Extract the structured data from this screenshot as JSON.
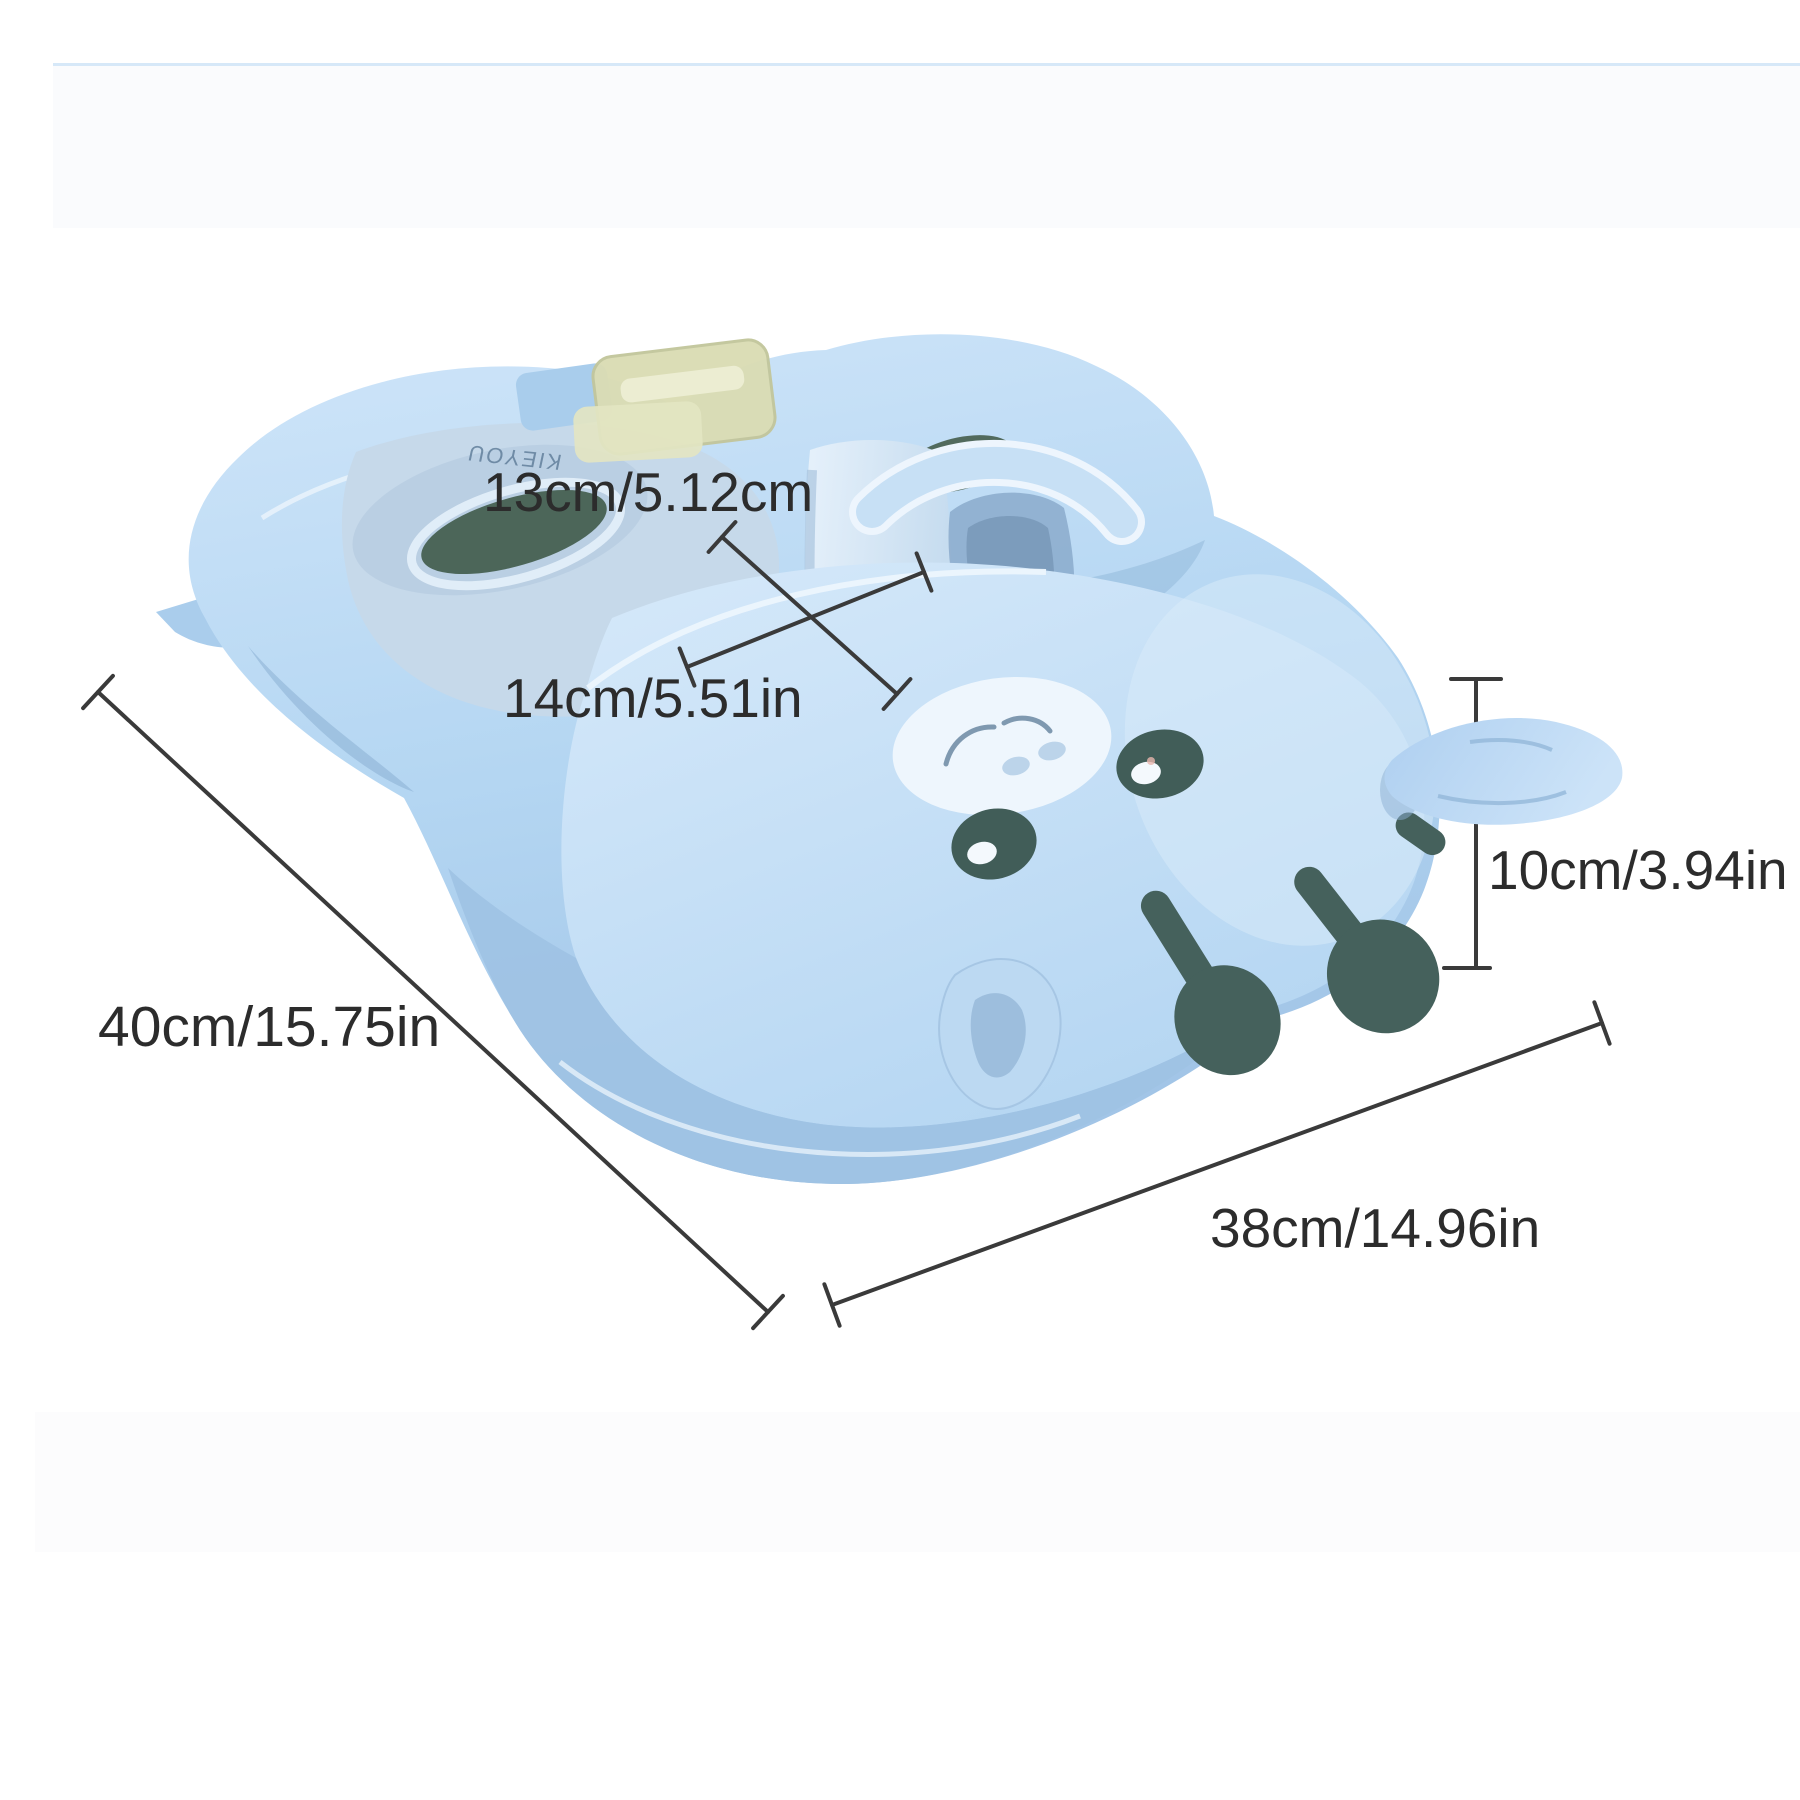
{
  "page": {
    "background_color": "#ffffff"
  },
  "photo_bands": {
    "top_edge_color": "#d6e8f8",
    "top_band_color": "#fafbfd",
    "bottom_band_color": "#fcfcfd"
  },
  "product": {
    "kind": "baby swim float seat, top 3/4 view",
    "brand_text": "KIEYOU",
    "colors": {
      "body_light": "#cfe5f9",
      "body_mid": "#aed2f0",
      "body_deep": "#a2c5e7",
      "pad_top": "#cde4f8",
      "seat_inner": "#c6d9ea",
      "slot_dark": "#4c6659",
      "legs_and_eyes": "#45615c",
      "snout_patch": "#eef6fd",
      "buckle": "#dadcb4"
    }
  },
  "annotations": {
    "line_color": "#3a3a3a",
    "text_color": "#2c2c2c",
    "labels": [
      {
        "id": "strap-width",
        "text": "13cm/5.12cm"
      },
      {
        "id": "seat-width",
        "text": "14cm/5.51in"
      },
      {
        "id": "height",
        "text": "10cm/3.94in"
      },
      {
        "id": "length",
        "text": "40cm/15.75in"
      },
      {
        "id": "width",
        "text": "38cm/14.96in"
      }
    ]
  }
}
